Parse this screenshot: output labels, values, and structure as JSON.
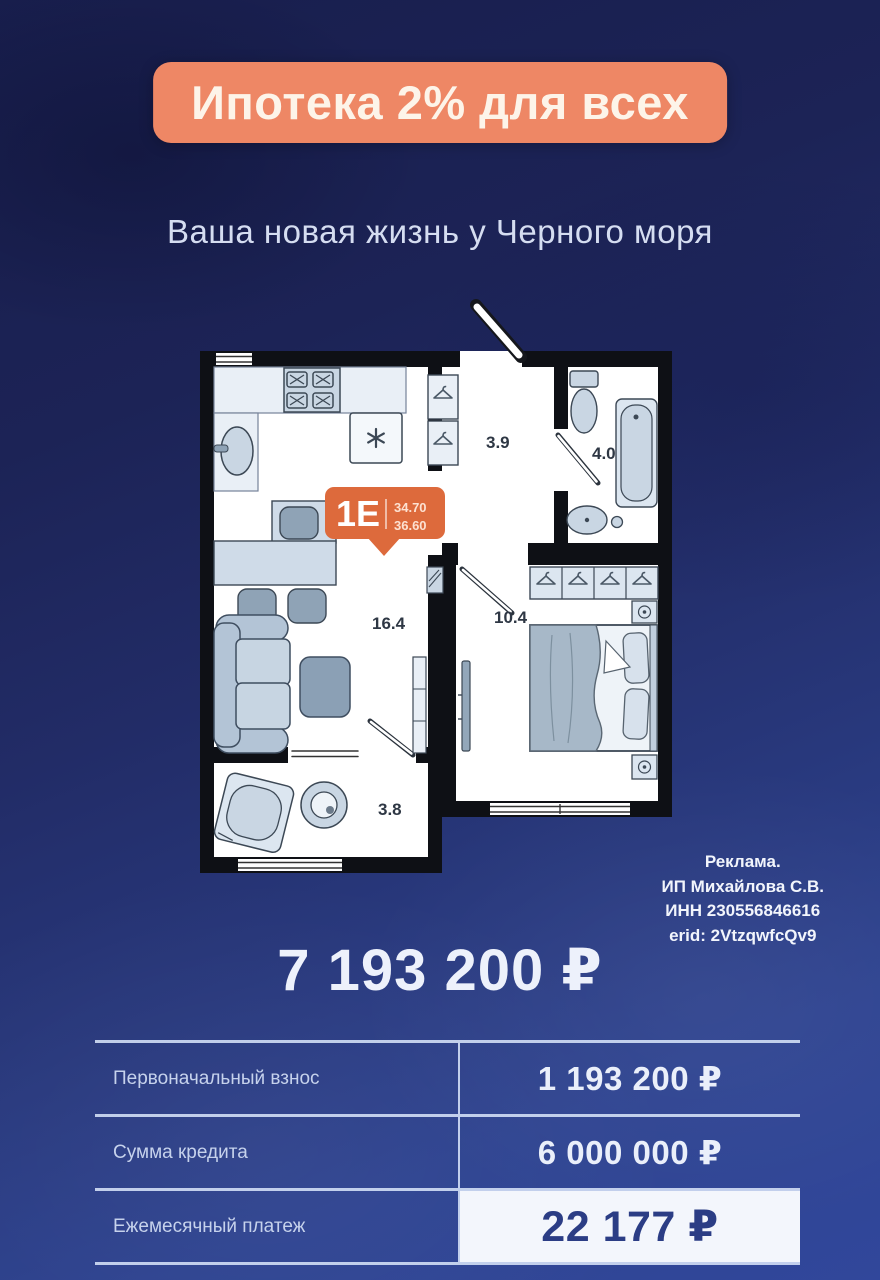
{
  "banner": {
    "title": "Ипотека 2% для всех",
    "bg": "#ee8765"
  },
  "subtitle": "Ваша новая жизнь у Черного моря",
  "floorplan": {
    "badge": {
      "unit": "1Е",
      "area1": "34.70",
      "area2": "36.60",
      "bg": "#dd6a3c"
    },
    "rooms": {
      "hall": "3.9",
      "bath": "4.0",
      "living": "16.4",
      "bedroom": "10.4",
      "laundry": "3.8"
    }
  },
  "legal": {
    "lines": [
      "Реклама.",
      "ИП Михайлова С.В.",
      "ИНН 230556846616",
      "erid: 2VtzqwfcQv9"
    ]
  },
  "price": "7 193 200 ₽",
  "table": {
    "rows": [
      {
        "label": "Первоначальный взнос",
        "value": "1 193 200 ₽"
      },
      {
        "label": "Сумма кредита",
        "value": "6 000 000 ₽"
      },
      {
        "label": "Ежемесячный платеж",
        "value": "22 177 ₽"
      }
    ]
  }
}
